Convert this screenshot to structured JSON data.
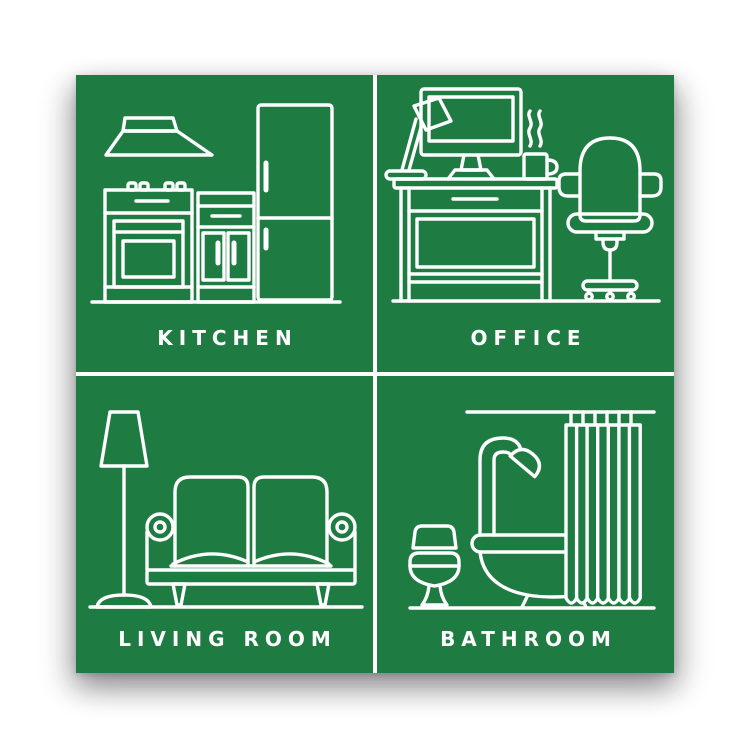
{
  "poster": {
    "colors": {
      "panel_green": "#1e7b41",
      "line_white": "#ffffff",
      "background": "#ffffff"
    },
    "panels": [
      {
        "key": "kitchen",
        "label": "KITCHEN",
        "icons": [
          "range-hood-icon",
          "stove-oven-icon",
          "cabinet-icon",
          "refrigerator-icon"
        ]
      },
      {
        "key": "office",
        "label": "OFFICE",
        "icons": [
          "desk-lamp-icon",
          "monitor-icon",
          "mug-icon",
          "desk-icon",
          "office-chair-icon"
        ]
      },
      {
        "key": "living_room",
        "label": "LIVING ROOM",
        "icons": [
          "floor-lamp-icon",
          "sofa-icon"
        ]
      },
      {
        "key": "bathroom",
        "label": "BATHROOM",
        "icons": [
          "toilet-icon",
          "bathtub-icon",
          "shower-head-icon",
          "shower-curtain-icon"
        ]
      }
    ]
  }
}
